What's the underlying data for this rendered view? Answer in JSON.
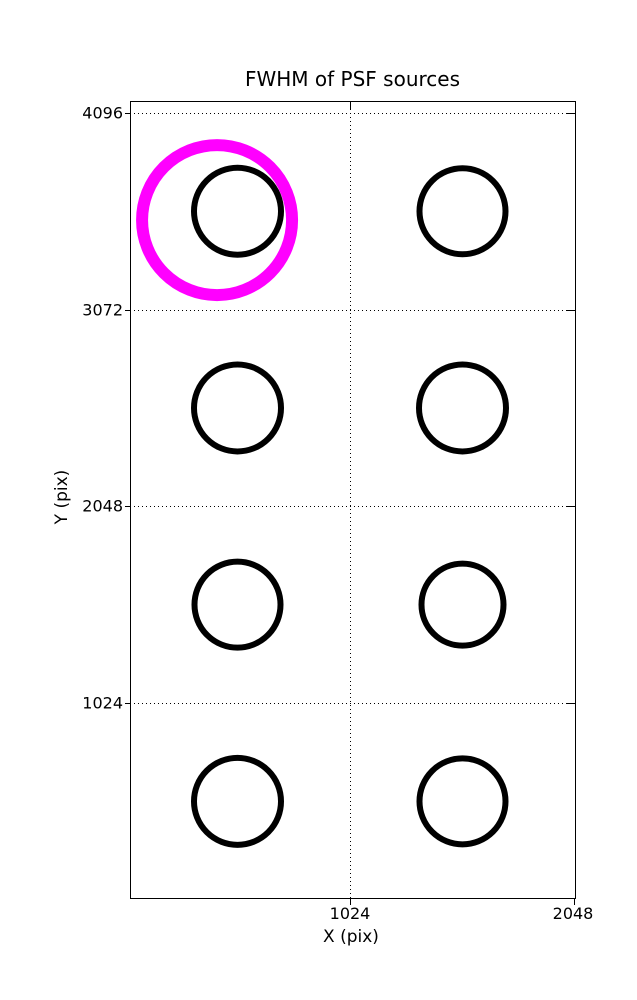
{
  "figure": {
    "title": "FWHM of PSF sources",
    "xlabel": "X (pix)",
    "ylabel": "Y (pix)"
  },
  "chart_data": {
    "type": "scatter",
    "title": "FWHM of PSF sources",
    "xlabel": "X (pix)",
    "ylabel": "Y (pix)",
    "xlim": [
      20,
      2048
    ],
    "ylim": [
      10,
      4160
    ],
    "x_ticks": [
      1024,
      2048
    ],
    "y_ticks": [
      1024,
      2048,
      3072,
      4096
    ],
    "x_tick_labels": [
      "1024",
      "2048"
    ],
    "y_tick_labels": [
      "1024",
      "2048",
      "3072",
      "4096"
    ],
    "grid": "dotted",
    "legend": "none",
    "marker": "open-circle",
    "points": [
      {
        "x": 512,
        "y": 3584,
        "r_px": 43.5
      },
      {
        "x": 1536,
        "y": 3584,
        "r_px": 43
      },
      {
        "x": 512,
        "y": 2560,
        "r_px": 43.5
      },
      {
        "x": 1536,
        "y": 2560,
        "r_px": 43.5
      },
      {
        "x": 512,
        "y": 1536,
        "r_px": 43
      },
      {
        "x": 1536,
        "y": 1536,
        "r_px": 41
      },
      {
        "x": 512,
        "y": 512,
        "r_px": 43.5
      },
      {
        "x": 1536,
        "y": 512,
        "r_px": 43
      }
    ],
    "highlight_circle": {
      "x": 419,
      "y": 3538,
      "r_px": 75,
      "stroke_px": 12,
      "color": "#FF00FF"
    }
  },
  "colors": {
    "marker": "#000000",
    "highlight": "#FF00FF",
    "background": "#FFFFFF",
    "text": "#000000",
    "frame": "#000000"
  }
}
